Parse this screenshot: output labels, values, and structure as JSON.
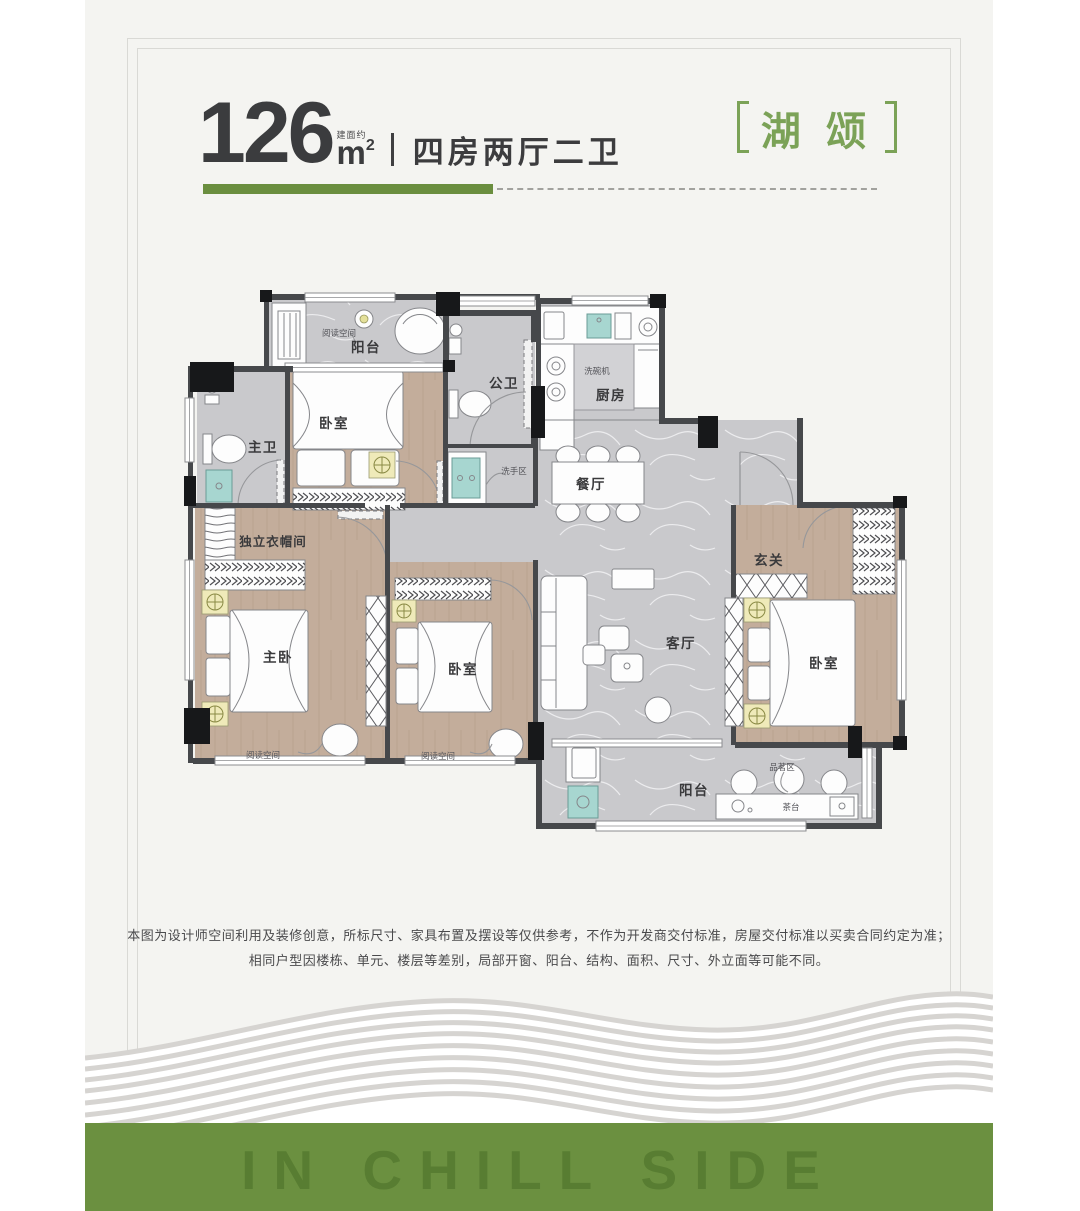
{
  "header": {
    "area_value": "126",
    "area_prefix": "建面约",
    "area_unit": "m",
    "area_sup": "2",
    "layout_text": "四房两厅二卫",
    "project": {
      "name": "湖 颂"
    }
  },
  "floorplan": {
    "rooms": {
      "balcony_top": "阳台",
      "bedroom_top": "卧室",
      "master_bath": "主卫",
      "public_bath": "公卫",
      "kitchen": "厨房",
      "dining": "餐厅",
      "cloakroom": "独立衣帽间",
      "master_bedroom": "主卧",
      "bedroom_mid": "卧室",
      "living": "客厅",
      "foyer": "玄关",
      "bedroom_right": "卧室",
      "balcony_bottom": "阳台"
    },
    "annotations": {
      "reading_top": "阅读空间",
      "reading_left": "阅读空间",
      "reading_mid": "阅读空间",
      "dishwasher": "洗碗机",
      "wash_area": "洗手区",
      "tea_zone": "品茗区",
      "tea_table": "茶台"
    }
  },
  "disclaimer": {
    "line1": "本图为设计师空间利用及装修创意，所标尺寸、家具布置及摆设等仅供参考，不作为开发商交付标准，房屋交付标准以买卖合同约定为准；",
    "line2": "相同户型因楼栋、单元、楼层等差别，局部开窗、阳台、结构、面积、尺寸、外立面等可能不同。"
  },
  "footer": {
    "slogan": "IN CHILL SIDE"
  },
  "colors": {
    "accent_green": "#6a8e3f",
    "brand_green": "#7ba257",
    "band_green": "#6b9040",
    "slogan_green": "#577c31"
  }
}
